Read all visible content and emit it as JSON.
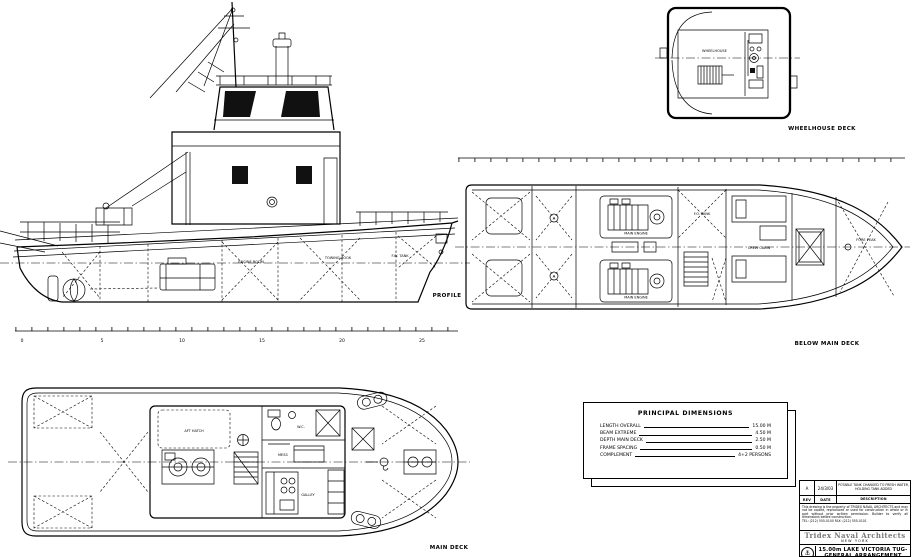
{
  "drawing": {
    "views": {
      "profile": {
        "caption": "PROFILE",
        "labels": {
          "engine_room": "ENGINE ROOM",
          "towing_hook": "TOWING HOOK",
          "fw_tank": "F.W. TANK"
        },
        "frame_numbers": [
          "0",
          "5",
          "10",
          "15",
          "20",
          "25"
        ]
      },
      "wheelhouse_deck": {
        "caption": "WHEELHOUSE DECK",
        "labels": {
          "wheelhouse": "WHEELHOUSE"
        }
      },
      "below_main_deck": {
        "caption": "BELOW MAIN DECK",
        "labels": {
          "main_engine": "MAIN ENGINE",
          "fo_tank": "F.O. TANK",
          "crew_cabin": "CREW CABIN",
          "fore_peak": "FORE PEAK"
        }
      },
      "main_deck": {
        "caption": "MAIN DECK",
        "labels": {
          "aft_hatch": "AFT HATCH",
          "wc": "W.C.",
          "mess": "MESS",
          "galley": "GALLEY"
        }
      }
    },
    "dimensions_table": {
      "title": "PRINCIPAL DIMENSIONS",
      "rows": [
        {
          "label": "LENGTH OVERALL",
          "value": "15.00 M"
        },
        {
          "label": "BEAM EXTREME",
          "value": "4.50 M"
        },
        {
          "label": "DEPTH MAIN DECK",
          "value": "2.50 M"
        },
        {
          "label": "FRAME SPACING",
          "value": "0.50 M"
        },
        {
          "label": "COMPLEMENT",
          "value": "4+2 PERSONS"
        }
      ]
    },
    "title_block": {
      "revision": {
        "rev": "A",
        "date": "24/3/03",
        "description": "POTABLE TANK CHANGED TO FRESH WATER, HOLDING TANK ADDED"
      },
      "headers": {
        "rev": "REV",
        "date": "DATE",
        "description": "DESCRIPTION"
      },
      "note": "This drawing is the property of TRIDEX NAVAL ARCHITECTS and may not be copied, reproduced or used for construction in whole or in part without prior written permission. Builder to verify all dimensions before construction.",
      "contact": "TEL: (212) 555-0100   FAX: (212) 555-0101",
      "firm": "Tridex Naval Architects",
      "firm_location": "NEW YORK",
      "title_line1": "15.00m LAKE VICTORIA TUG-",
      "title_line2": "GENERAL ARRANGEMENT",
      "logo": "anchor-icon"
    }
  }
}
